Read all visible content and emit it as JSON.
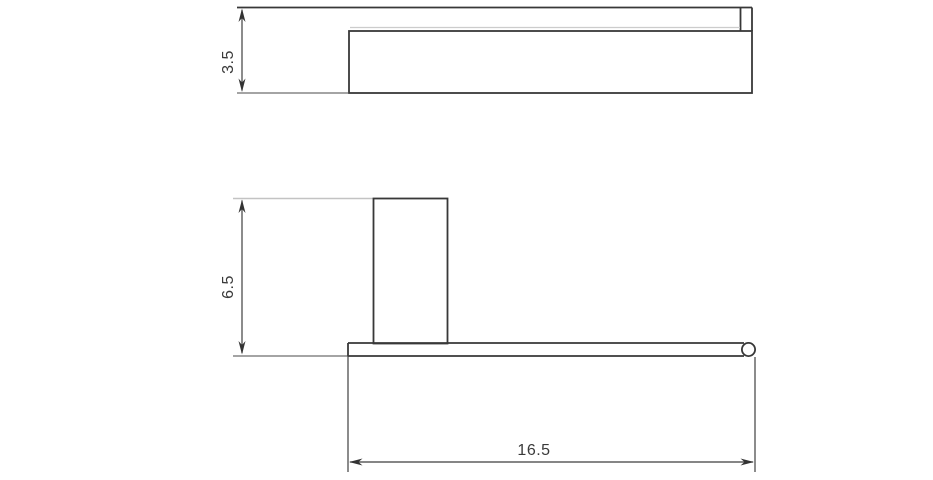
{
  "drawing": {
    "kind": "technical-orthographic-drawing",
    "views": {
      "top_view": {
        "depth_dimension": {
          "label": "3.5",
          "orientation": "vertical"
        }
      },
      "front_view": {
        "height_dimension": {
          "label": "6.5",
          "orientation": "vertical"
        },
        "width_dimension": {
          "label": "16.5",
          "orientation": "horizontal"
        }
      }
    },
    "colors": {
      "background": "#ffffff",
      "object_line": "#383838",
      "dimension_line": "#3f3f3f",
      "faint_edge_line": "#cccccc",
      "light_extension_line": "#c3c3c3",
      "dimension_text": "#3a3a3a"
    }
  }
}
